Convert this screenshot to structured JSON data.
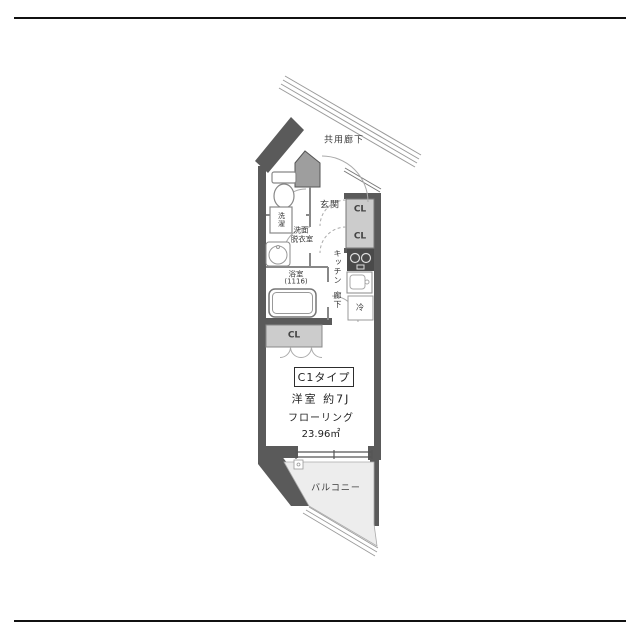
{
  "floorplan": {
    "common_corridor": "共用廊下",
    "entrance": "玄関",
    "closet_top_1": "CL",
    "closet_top_2": "CL",
    "closet_hall": "CL",
    "washer": "洗濯",
    "washroom_line1": "洗面",
    "washroom_line2": "脱衣室",
    "bathroom_line1": "浴室",
    "bathroom_line2": "(1116)",
    "kitchen": "キッチン",
    "hallway": "廊下",
    "refrigerator": "冷",
    "unit_type": "C1タイプ",
    "main_room": "洋室 約7J",
    "flooring": "フローリング",
    "area": "23.96㎡",
    "balcony": "バルコニー",
    "colors": {
      "wall": "#5a5a5a",
      "partition": "#888888",
      "closet_fill": "#cccccc",
      "balcony_fill": "#ededed",
      "door_arc": "#aaaaaa",
      "frame": "#111111",
      "text": "#3a3a3a"
    }
  }
}
